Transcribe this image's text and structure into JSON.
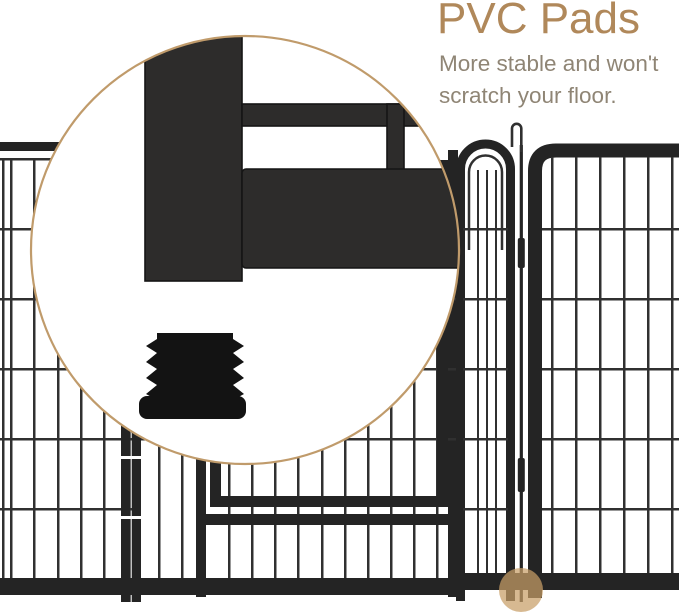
{
  "heading": {
    "title": "PVC Pads",
    "subtitle_line1": "More stable and won't",
    "subtitle_line2": "scratch your floor."
  },
  "colors": {
    "accent": "#b0885a",
    "subtitle": "#8f8575",
    "fence": "#242424",
    "wire": "#303030",
    "tube": "#2d2c2b",
    "tube_edge": "#151515",
    "pad": "#131313",
    "magnifier_border": "#c09b6b",
    "highlight": "#c89e66",
    "background": "#ffffff"
  },
  "figure": {
    "magnifier_shows": "pvc-pad-closeup",
    "highlight_dot_marks": "panel-foot"
  }
}
